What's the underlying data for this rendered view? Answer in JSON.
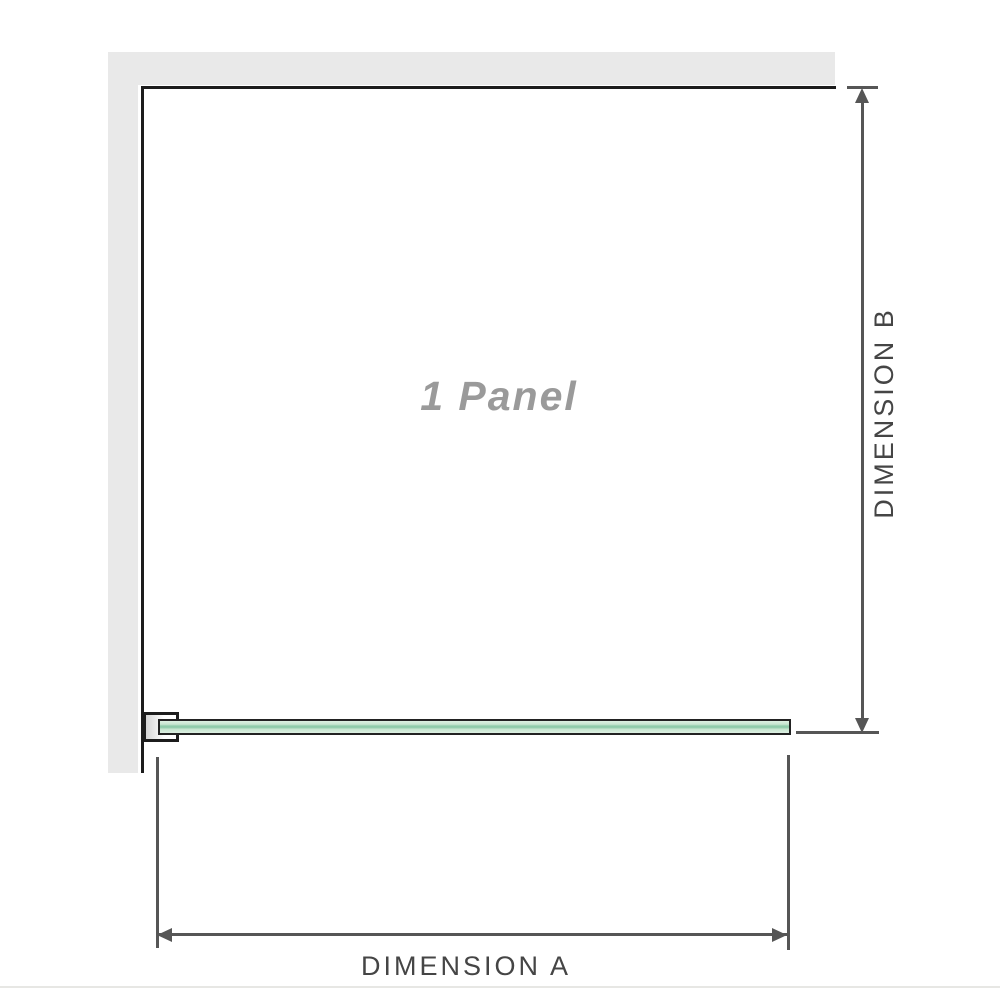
{
  "diagram": {
    "panel_label": "1 Panel",
    "dimension_a_label": "DIMENSION A",
    "dimension_b_label": "DIMENSION B"
  },
  "colors": {
    "wall_fill": "#e9e9e9",
    "wall_edge": "#1c1c1c",
    "glass_border": "#222222",
    "glass_fill": "#c6e5cf",
    "glass_edge_line": "#8fcbaa",
    "dimension_line": "#565656",
    "dimension_text": "#454545",
    "panel_text": "#9a9a9a",
    "page_edge": "#e7e7e4"
  }
}
